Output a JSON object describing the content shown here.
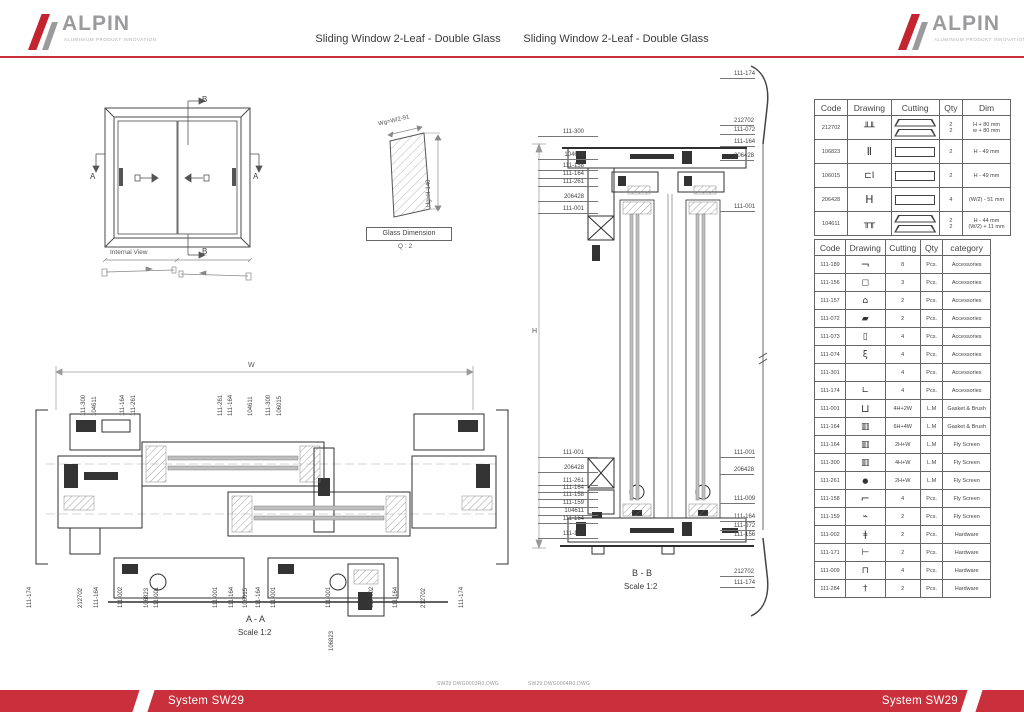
{
  "header": {
    "logo": {
      "brand": "ALPIN",
      "tagline": "ALUMINIUM PRODUKT INNOVATION"
    },
    "title_left": "Sliding Window  2-Leaf - Double Glass",
    "title_right": "Sliding Window  2-Leaf - Double Glass"
  },
  "internal_view": {
    "caption": "Internal View",
    "marker_a": "A",
    "marker_b": "B"
  },
  "glass_dimension": {
    "caption": "Glass Dimension",
    "qty_note": "Q : 2",
    "width_label": "Wg=W/2-91",
    "height_label": "Hg=H-140"
  },
  "section_aa": {
    "caption": "A - A",
    "scale": "Scale 1:2",
    "width_dim_label": "W",
    "top_labels": [
      {
        "t": "111-300",
        "x": 70
      },
      {
        "t": "104611",
        "x": 81
      },
      {
        "t": "111-164",
        "x": 109
      },
      {
        "t": "111-261",
        "x": 120
      },
      {
        "t": "111-261",
        "x": 207
      },
      {
        "t": "111-164",
        "x": 217
      },
      {
        "t": "104611",
        "x": 237
      },
      {
        "t": "111-300",
        "x": 255
      },
      {
        "t": "106015",
        "x": 266
      }
    ],
    "bottom_labels": [
      {
        "t": "111-174",
        "x": 16
      },
      {
        "t": "212702",
        "x": 67
      },
      {
        "t": "111-164",
        "x": 83
      },
      {
        "t": "111-002",
        "x": 107
      },
      {
        "t": "106823",
        "x": 133
      },
      {
        "t": "111-001",
        "x": 143
      },
      {
        "t": "111-001",
        "x": 202
      },
      {
        "t": "111-164",
        "x": 218
      },
      {
        "t": "106015",
        "x": 232
      },
      {
        "t": "111-164",
        "x": 245
      },
      {
        "t": "111-001",
        "x": 260
      },
      {
        "t": "111-001",
        "x": 315
      },
      {
        "t": "111-002",
        "x": 358
      },
      {
        "t": "111-164",
        "x": 382
      },
      {
        "t": "212702",
        "x": 410
      },
      {
        "t": "111-174",
        "x": 448
      },
      {
        "t": "106823",
        "x": 318,
        "y": 292
      }
    ]
  },
  "section_bb": {
    "caption": "B - B",
    "scale": "Scale 1:2",
    "height_dim_label": "H",
    "left_labels": [
      {
        "t": "111-300",
        "y": 69
      },
      {
        "t": "104611",
        "y": 92
      },
      {
        "t": "111-158",
        "y": 103
      },
      {
        "t": "111-164",
        "y": 111
      },
      {
        "t": "111-261",
        "y": 119
      },
      {
        "t": "206428",
        "y": 134
      },
      {
        "t": "111-001",
        "y": 146
      },
      {
        "t": "111-001",
        "y": 390
      },
      {
        "t": "206428",
        "y": 405
      },
      {
        "t": "111-261",
        "y": 418
      },
      {
        "t": "111-164",
        "y": 425
      },
      {
        "t": "111-158",
        "y": 432
      },
      {
        "t": "111-159",
        "y": 440
      },
      {
        "t": "104611",
        "y": 448
      },
      {
        "t": "111-164",
        "y": 456
      },
      {
        "t": "111-157",
        "y": 471
      }
    ],
    "right_labels": [
      {
        "t": "111-174",
        "y": 11
      },
      {
        "t": "212702",
        "y": 58
      },
      {
        "t": "111-072",
        "y": 67
      },
      {
        "t": "111-164",
        "y": 79
      },
      {
        "t": "206428",
        "y": 93
      },
      {
        "t": "111-001",
        "y": 144
      },
      {
        "t": "111-001",
        "y": 390
      },
      {
        "t": "206428",
        "y": 407
      },
      {
        "t": "111-009",
        "y": 436
      },
      {
        "t": "111-164",
        "y": 454
      },
      {
        "t": "111-072",
        "y": 463
      },
      {
        "t": "111-156",
        "y": 472
      },
      {
        "t": "212702",
        "y": 509
      },
      {
        "t": "111-174",
        "y": 520
      }
    ]
  },
  "cut_table": {
    "headers": [
      "Code",
      "Drawing",
      "Cutting",
      "Qty",
      "Dim"
    ],
    "rows": [
      {
        "code": "212702",
        "icon": "frame-profile-icon",
        "cut": "trap2",
        "qty": "2\n2",
        "dim": "H + 80 mm\nw + 80 mm"
      },
      {
        "code": "106823",
        "icon": "interlock-profile-icon",
        "cut": "rect",
        "qty": "2",
        "dim": "H - 49 mm"
      },
      {
        "code": "106015",
        "icon": "sash-profile-icon",
        "cut": "rect",
        "qty": "2",
        "dim": "H - 49 mm"
      },
      {
        "code": "206428",
        "icon": "glazing-bead-icon",
        "cut": "rect",
        "qty": "4",
        "dim": "(W/2) - 51 mm"
      },
      {
        "code": "104611",
        "icon": "track-profile-icon",
        "cut": "trap2",
        "qty": "2\n2",
        "dim": "H - 44 mm\n(W/2) + 11 mm"
      }
    ]
  },
  "parts_table": {
    "headers": [
      "Code",
      "Drawing",
      "Cutting",
      "Qty",
      "category"
    ],
    "rows": [
      {
        "code": "111-189",
        "icon": "corner-bracket-icon",
        "cutting": "8",
        "qty": "Pcs.",
        "category": "Accessories"
      },
      {
        "code": "111-156",
        "icon": "end-cap-icon",
        "cutting": "3",
        "qty": "Pcs.",
        "category": "Accessories"
      },
      {
        "code": "111-157",
        "icon": "guide-block-icon",
        "cutting": "2",
        "qty": "Pcs.",
        "category": "Accessories"
      },
      {
        "code": "111-072",
        "icon": "roller-icon",
        "cutting": "2",
        "qty": "Pcs.",
        "category": "Accessories"
      },
      {
        "code": "111-073",
        "icon": "clip-icon",
        "cutting": "4",
        "qty": "Pcs.",
        "category": "Accessories"
      },
      {
        "code": "111-074",
        "icon": "anti-lift-icon",
        "cutting": "4",
        "qty": "Pcs.",
        "category": "Accessories"
      },
      {
        "code": "111-301",
        "icon": "",
        "cutting": "4",
        "qty": "Pcs.",
        "category": "Accessories"
      },
      {
        "code": "111-174",
        "icon": "angle-icon",
        "cutting": "4",
        "qty": "Pcs.",
        "category": "Accessories"
      },
      {
        "code": "111-001",
        "icon": "u-gasket-icon",
        "cutting": "4H+2W",
        "qty": "L.M",
        "category": "Gasket & Brush"
      },
      {
        "code": "111-164",
        "icon": "brush-icon",
        "cutting": "6H+4W",
        "qty": "L.M",
        "category": "Gasket & Brush"
      },
      {
        "code": "111-164",
        "icon": "brush-icon",
        "cutting": "2H+W",
        "qty": "L.M",
        "category": "Fly Screen"
      },
      {
        "code": "111-300",
        "icon": "brush-icon",
        "cutting": "4H+W",
        "qty": "L.M",
        "category": "Fly Screen"
      },
      {
        "code": "111-261",
        "icon": "round-gasket-icon",
        "cutting": "2H+W",
        "qty": "L.M",
        "category": "Fly Screen"
      },
      {
        "code": "111-158",
        "icon": "corner-piece-icon",
        "cutting": "4",
        "qty": "Pcs.",
        "category": "Fly Screen"
      },
      {
        "code": "111-159",
        "icon": "latch-icon",
        "cutting": "2",
        "qty": "Pcs.",
        "category": "Fly Screen"
      },
      {
        "code": "111-002",
        "icon": "pin-icon",
        "cutting": "2",
        "qty": "Pcs.",
        "category": "Hardware"
      },
      {
        "code": "111-171",
        "icon": "handle-icon",
        "cutting": "2",
        "qty": "Pcs.",
        "category": "Hardware"
      },
      {
        "code": "111-009",
        "icon": "lock-keeper-icon",
        "cutting": "4",
        "qty": "Pcs.",
        "category": "Hardware"
      },
      {
        "code": "111-284",
        "icon": "bolt-icon",
        "cutting": "2",
        "qty": "Pcs.",
        "category": "Hardware"
      }
    ]
  },
  "footer": {
    "file_left": "SW29 DWG0003R0.DWG",
    "file_right": "SW29 DWG0004R0.DWG",
    "system_left": "System SW29",
    "system_right": "System SW29"
  },
  "colors": {
    "accent_red": "#C9303B",
    "logo_red": "#C42430",
    "logo_gray": "#9B9B9D",
    "line_dark": "#2F2F2F"
  }
}
